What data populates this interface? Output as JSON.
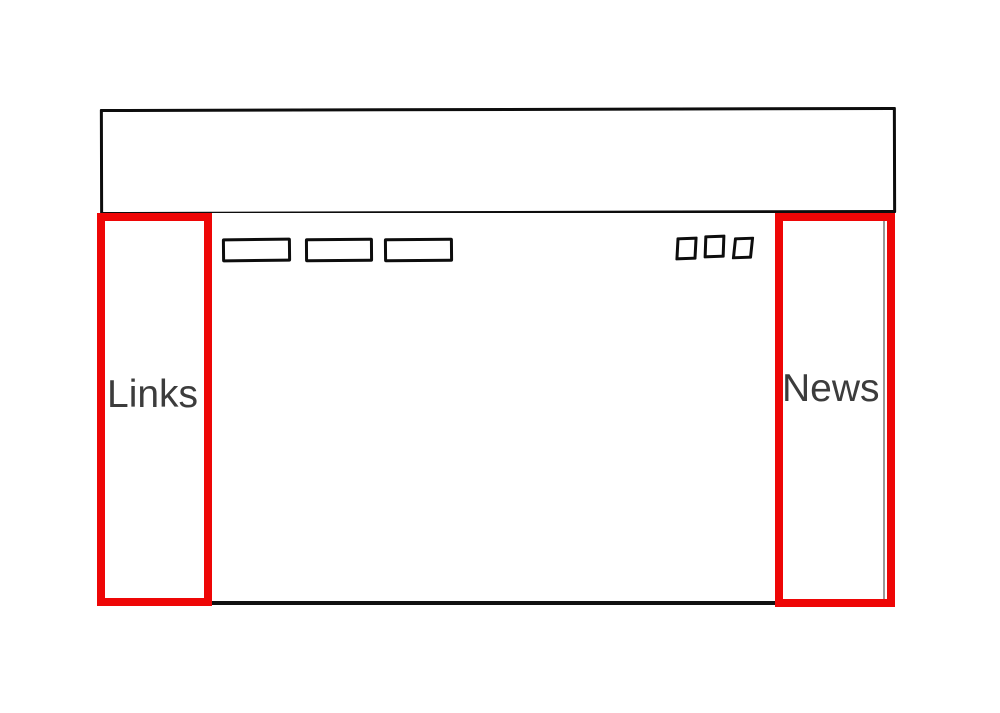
{
  "canvas": {
    "background": "#ffffff",
    "stroke_color": "#0d0d0d",
    "highlight_color": "#ee0606",
    "label_color": "#3c3c3c"
  },
  "sidebars": {
    "left": {
      "label": "Links"
    },
    "right": {
      "label": "News"
    }
  },
  "icons": {
    "nav_button": "rectangle-outline",
    "toolbar_square": "square-outline"
  }
}
